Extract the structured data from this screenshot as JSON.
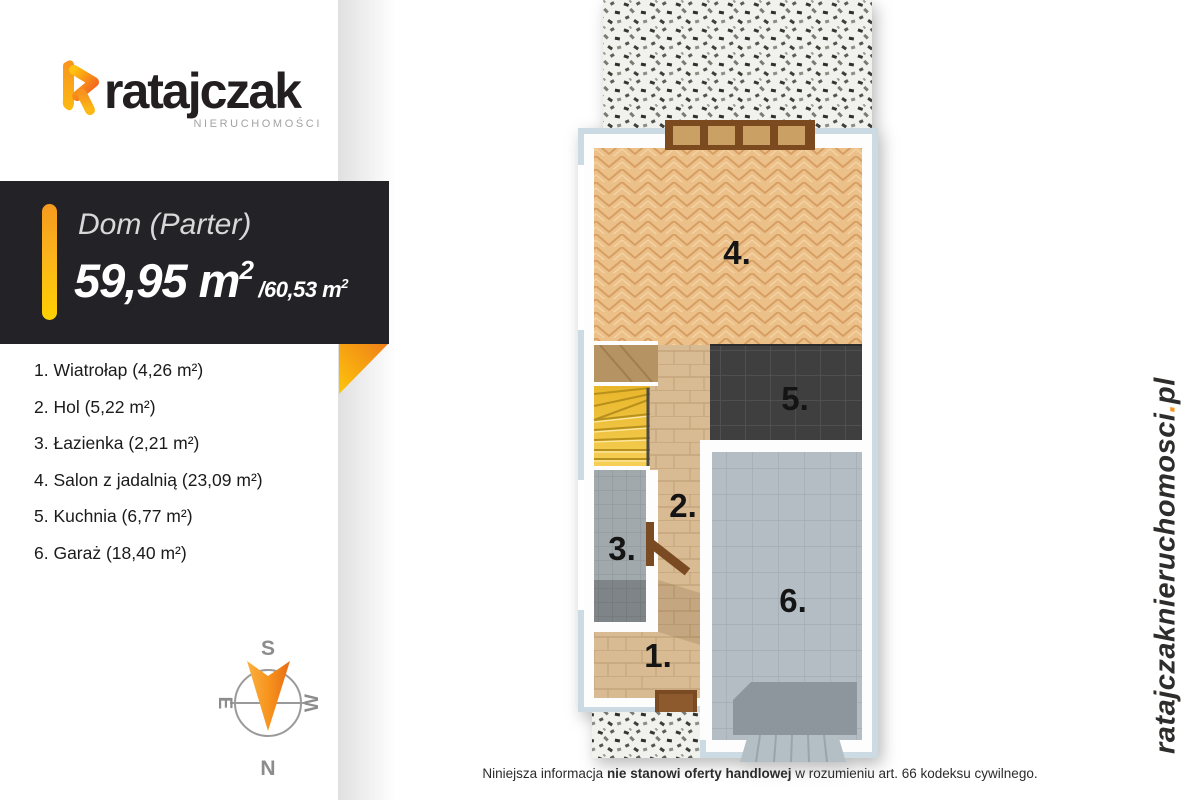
{
  "logo": {
    "brand": "ratajczak",
    "subtitle": "NIERUCHOMOŚCI"
  },
  "banner": {
    "title": "Dom (Parter)",
    "area_value": "59,95",
    "area_unit": " m",
    "area_sup": "2",
    "area_secondary": "/60,53 m",
    "area_secondary_sup": "2"
  },
  "rooms": [
    {
      "label": "1. Wiatrołap (4,26 m²)"
    },
    {
      "label": "2. Hol (5,22 m²)"
    },
    {
      "label": "3. Łazienka (2,21 m²)"
    },
    {
      "label": "4. Salon z jadalnią (23,09 m²)"
    },
    {
      "label": "5. Kuchnia (6,77 m²)"
    },
    {
      "label": "6. Garaż (18,40 m²)"
    }
  ],
  "floorplan": {
    "labels": {
      "salon": "4.",
      "kuchnia": "5.",
      "hol": "2.",
      "lazienka": "3.",
      "wiatrolap": "1.",
      "garaz": "6."
    }
  },
  "compass": {
    "n": "N",
    "s": "S",
    "e": "E",
    "w": "W"
  },
  "url": {
    "main": "ratajczaknieruchomosci",
    "dot": ".",
    "tld": "pl"
  },
  "disclaimer": {
    "pre": "Niniejsza informacja ",
    "bold": "nie stanowi oferty handlowej",
    "post": " w rozumieniu art. 66 kodeksu cywilnego."
  },
  "colors": {
    "accent_orange": "#f7941e",
    "accent_yellow": "#ffd102",
    "banner_bg": "#232227",
    "wall_blue": "#ccdae3",
    "wood_salon": "#ecc089",
    "wood_plank": "#d8bb93",
    "kitchen_dark": "#3f3f3f",
    "garage_gray": "#b5bdc4",
    "stairs_yellow": "#f0c544"
  }
}
